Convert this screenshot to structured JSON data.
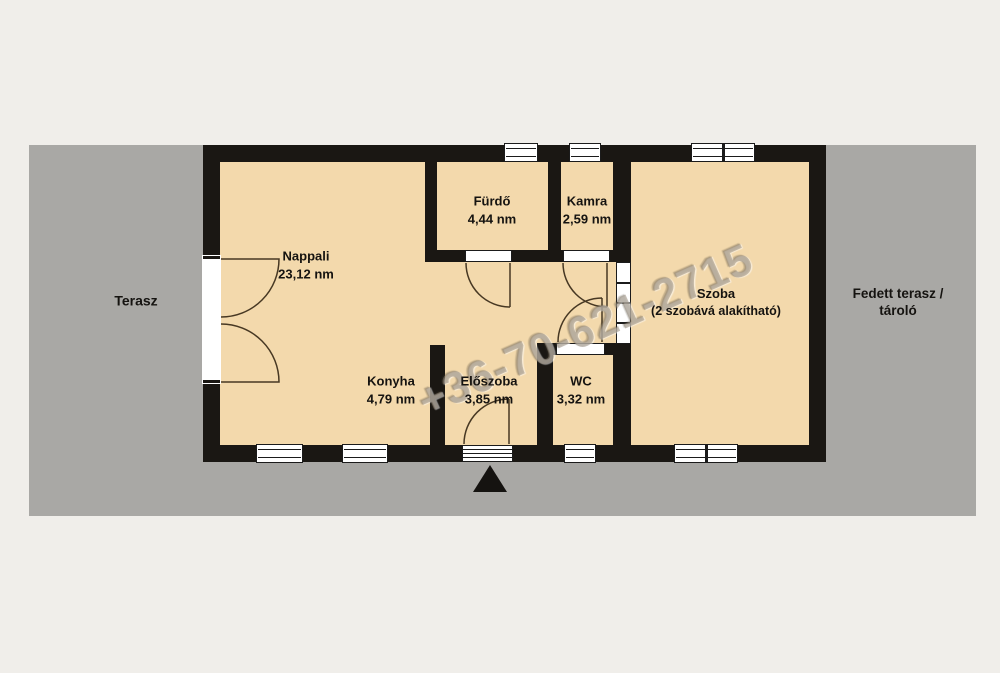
{
  "colors": {
    "page_background": "#f0eeea",
    "terrace_gray": "#a9a8a5",
    "room_fill": "#f3d9ac",
    "wall_black": "#1a1713",
    "door_line": "#473823",
    "label_text": "#151310"
  },
  "rooms": [
    {
      "name": "Nappali",
      "area": "23,12 nm"
    },
    {
      "name": "Fürdő",
      "area": "4,44 nm"
    },
    {
      "name": "Kamra",
      "area": "2,59 nm"
    },
    {
      "name": "Szoba",
      "note": "(2 szobává alakítható)"
    },
    {
      "name": "Konyha",
      "area": "4,79 nm"
    },
    {
      "name": "Előszoba",
      "area": "3,85 nm"
    },
    {
      "name": "WC",
      "area": "3,32 nm"
    }
  ],
  "outdoor": {
    "left_label": "Terasz",
    "right_label": "Fedett terasz / tároló"
  },
  "watermark": {
    "phone": "+36-70-621-2715"
  },
  "icons": {
    "entrance_marker": "entrance-arrow-triangle"
  }
}
